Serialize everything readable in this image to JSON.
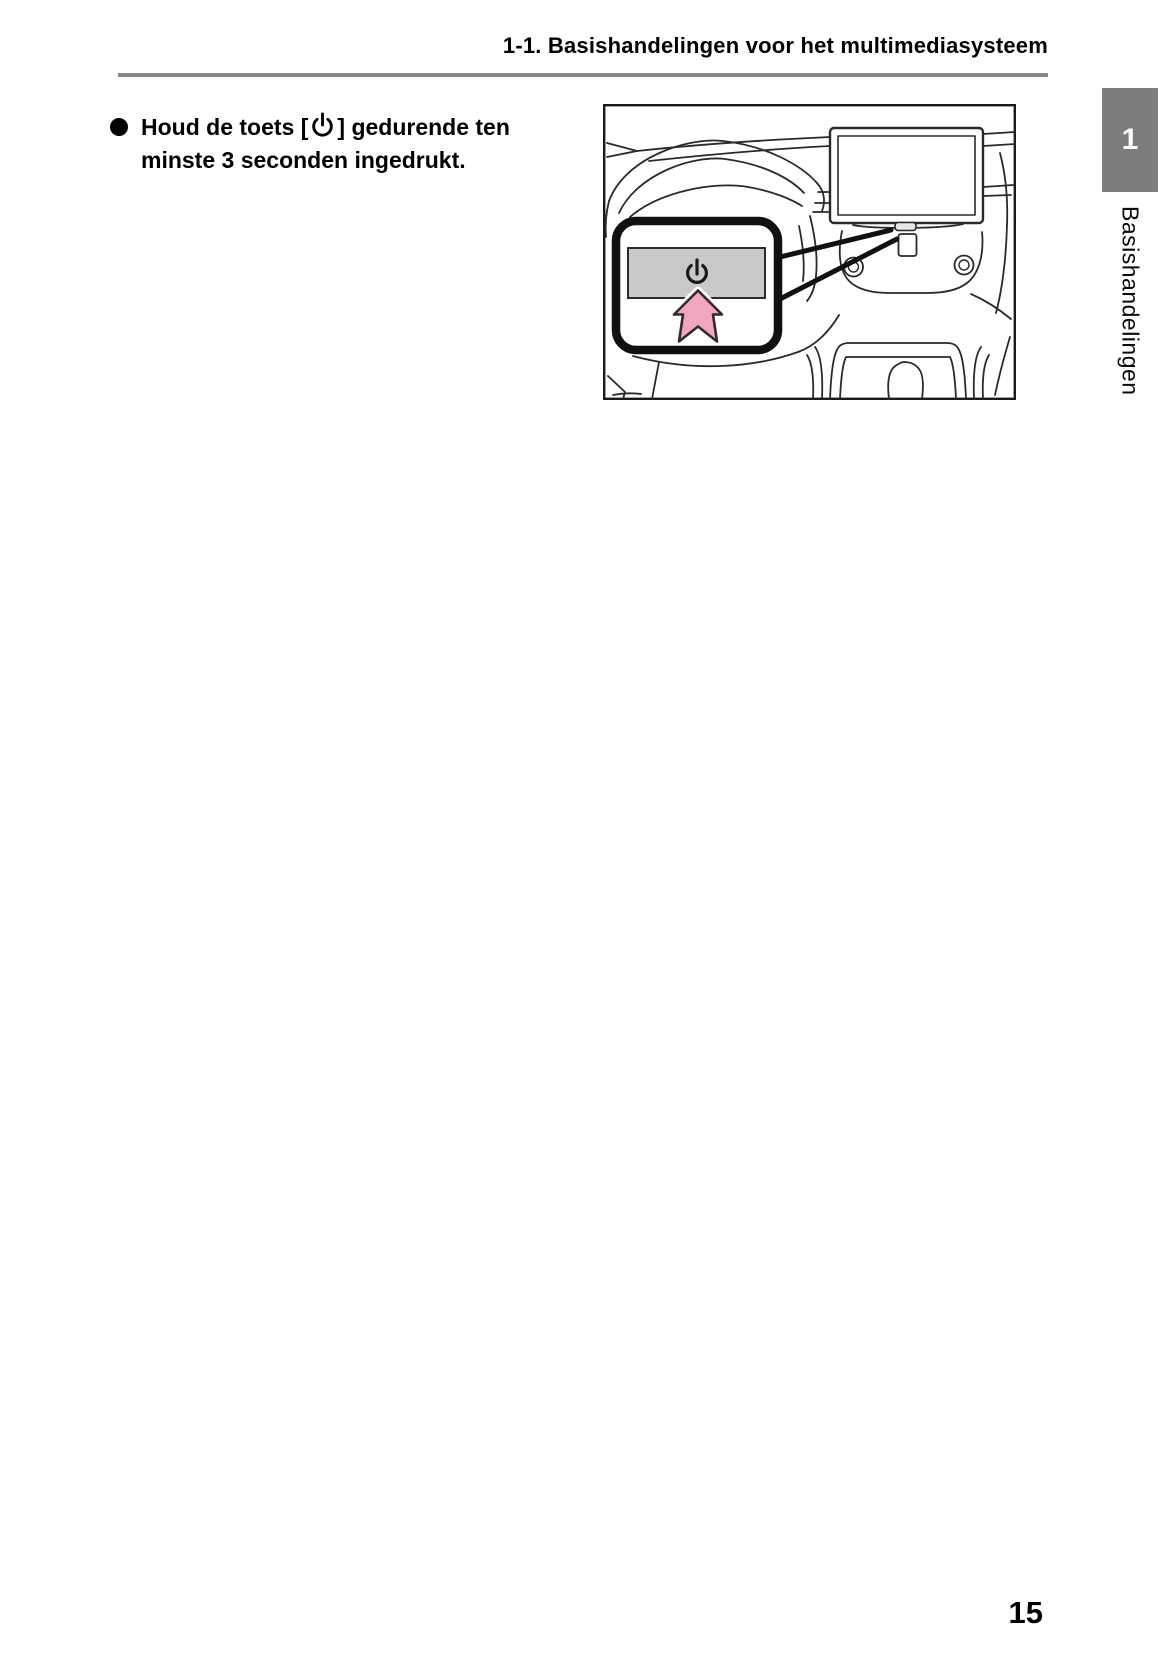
{
  "header": {
    "section_title": "1-1. Basishandelingen voor het multimediasysteem"
  },
  "content": {
    "instruction": {
      "text_before_icon": "Houd de toets [",
      "text_after_icon": "] gedurende ten",
      "text_line2": "minste 3 seconden ingedrukt."
    }
  },
  "figure": {
    "subject": "car dashboard line drawing with multimedia display, callout of gray power button, pink press arrow"
  },
  "sidebar": {
    "chapter_number": "1",
    "chapter_label": "Basishandelingen"
  },
  "footer": {
    "page_number": "15"
  },
  "icons": {
    "bullet": "filled-circle",
    "power": "power-symbol",
    "press_arrow": "up-arrow"
  },
  "colors": {
    "rule_gray": "#8a8a8a",
    "tab_gray": "#7d7d7d",
    "button_gray": "#c9c9c9",
    "arrow_pink": "#f0a6c1",
    "arrow_outline": "#35292e",
    "line_art": "#2a2a2a"
  }
}
